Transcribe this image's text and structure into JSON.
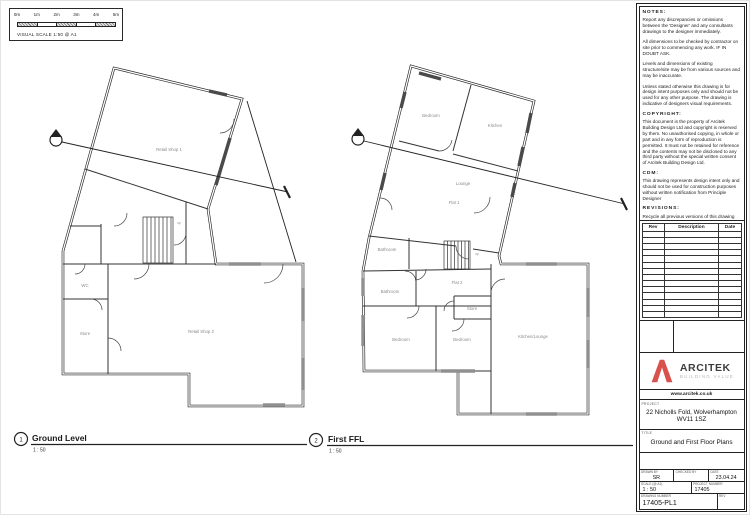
{
  "scale_bar": {
    "ticks": [
      "0m",
      "1m",
      "2m",
      "3m",
      "4m",
      "5m"
    ],
    "caption": "VISUAL SCALE 1:50 @ A1"
  },
  "plans": {
    "ground": {
      "number": "1",
      "title": "Ground Level",
      "scale": "1 : 50",
      "rooms": {
        "retail1": "Retail Shop 1",
        "retail2": "Retail Shop 2",
        "wc": "WC",
        "store": "Store",
        "stair": "up"
      }
    },
    "first": {
      "number": "2",
      "title": "First FFL",
      "scale": "1 : 50",
      "rooms": {
        "bedroom1": "Bedroom",
        "kitchen": "Kitchen",
        "lounge": "Lounge",
        "flat1": "Flat 1",
        "bathroom_a": "Bathroom",
        "flat2": "Flat 2",
        "bathroom_b": "Bathroom",
        "store": "Store",
        "bedroom2": "Bedroom",
        "bedroom3": "Bedroom",
        "kitchen_lounge": "Kitchen/Lounge",
        "stair": "up"
      }
    }
  },
  "notes": {
    "blocks": [
      {
        "heading": "NOTES:",
        "paras": [
          "Report any discrepancies or omissions between the 'Designer' and any consultants drawings to the designer immediately.",
          "All dimensions to be checked by contractor on site prior to commencing any work. IF IN DOUBT ASK.",
          "Levels and dimensions of existing structure/site may be from various sources and may be inaccurate.",
          "Unless stated otherwise this drawing is for design intent purposes only and should not be used for any other purpose. The drawing is indicative of designers visual requirements."
        ]
      },
      {
        "heading": "COPYRIGHT:",
        "paras": [
          "This document is the property of Arcitek Building Design Ltd and copyright is reserved by them. No unauthorised copying, in whole or part and in any form of reproduction is permitted. It must not be retained for reference and the contents may not be disclosed to any third party without the special written consent of Arcitek Building Design Ltd."
        ]
      },
      {
        "heading": "CDM:",
        "paras": [
          "This drawing represents design intent only and should not be used for construction purposes without written notification from Principle Designer"
        ]
      },
      {
        "heading": "REVISIONS:",
        "paras": [
          "Recycle all previous versions of this drawing and check with designer that you have the latest revision."
        ]
      }
    ]
  },
  "rev_table": {
    "headers": [
      "Rev",
      "Description",
      "Date"
    ],
    "empty_rows": 14
  },
  "brand": {
    "name": "ARCITEK",
    "tagline": "BUILDING VALUE",
    "website": "www.arcitek.co.uk",
    "logo_color": "#d9514c"
  },
  "title_block": {
    "project_label": "PROJECT",
    "project_line1": "22 Nicholls Fold, Wolverhampton",
    "project_line2": "WV11 1SZ",
    "title_label": "TITLE",
    "title": "Ground and First Floor Plans",
    "fields": {
      "drawn_by_label": "DRAWN BY",
      "drawn_by": "SR",
      "checked_by_label": "CHECKED BY",
      "checked_by": "",
      "date_label": "DATE",
      "date": "23.04.24",
      "scale_label": "SCALE (@ A1)",
      "scale": "1 : 50",
      "project_number_label": "PROJECT NUMBER",
      "project_number": "17405",
      "drawing_number_label": "DRAWING NUMBER",
      "drawing_number": "17405-PL1",
      "rev_label": "REV",
      "rev": ""
    }
  }
}
